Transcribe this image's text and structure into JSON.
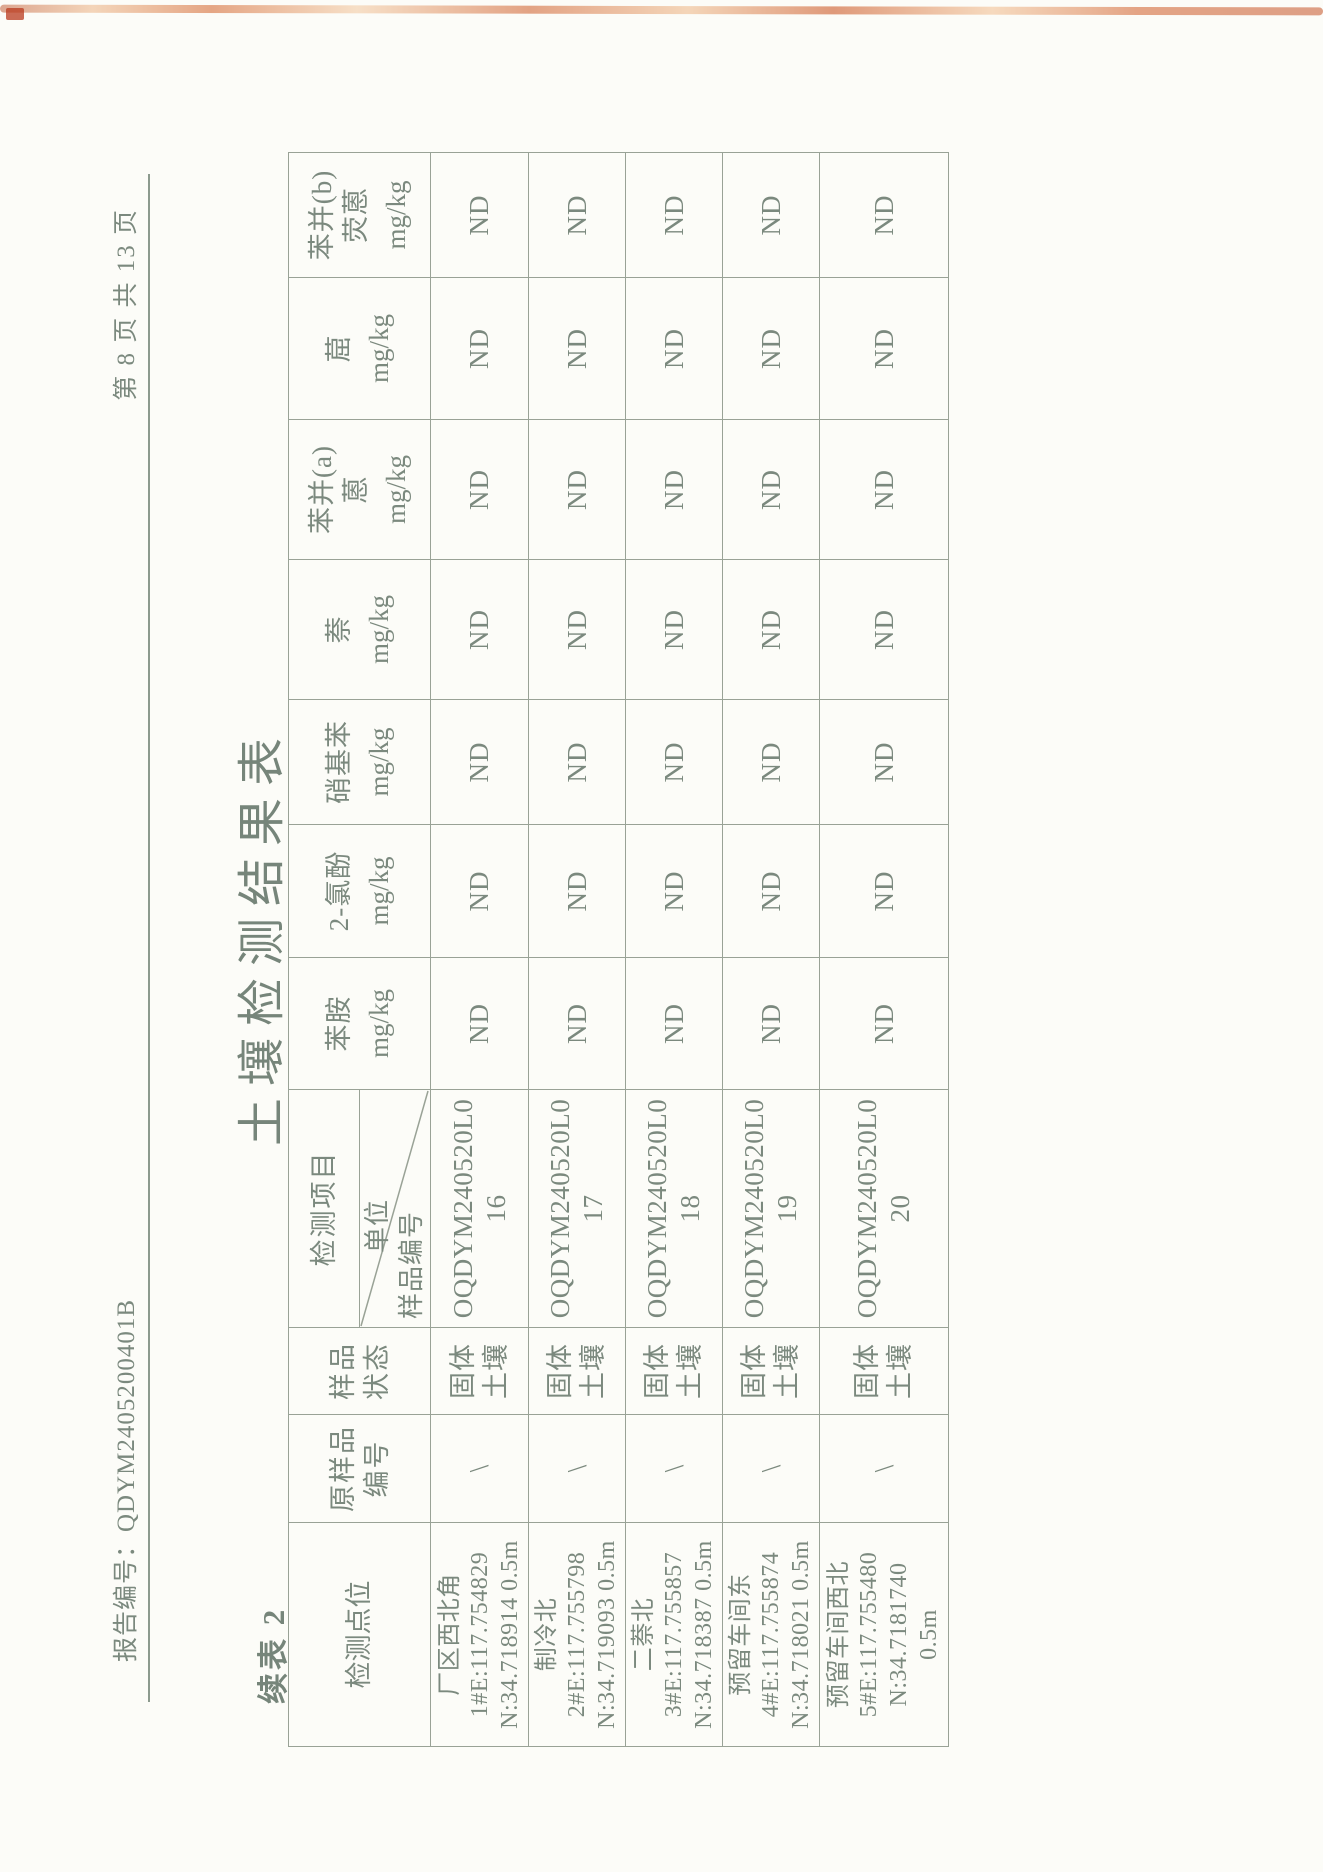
{
  "page": {
    "report_number": "报告编号：QDYM2405200401B",
    "page_indicator": "第 8 页 共 13 页",
    "title": "土壤检测结果表",
    "continuation_label": "续表 2"
  },
  "table": {
    "header": {
      "point": "检测点位",
      "orig_sample": [
        "原样品",
        "编号"
      ],
      "state": [
        "样品",
        "状态"
      ],
      "corner": {
        "project": "检测项目",
        "unit": "单位",
        "sample_no": "样品编号"
      },
      "analytes": [
        {
          "name": [
            "苯胺"
          ],
          "unit": "mg/kg"
        },
        {
          "name": [
            "2-氯酚"
          ],
          "unit": "mg/kg"
        },
        {
          "name": [
            "硝基苯"
          ],
          "unit": "mg/kg"
        },
        {
          "name": [
            "萘"
          ],
          "unit": "mg/kg"
        },
        {
          "name": [
            "苯并(a)",
            "蒽"
          ],
          "unit": "mg/kg"
        },
        {
          "name": [
            "䓛"
          ],
          "unit": "mg/kg"
        },
        {
          "name": [
            "苯并(b)",
            "荧蒽"
          ],
          "unit": "mg/kg"
        }
      ]
    },
    "rows": [
      {
        "point": [
          "厂区西北角",
          "1#E:117.754829",
          "N:34.718914 0.5m"
        ],
        "orig": "\\",
        "state": [
          "固体",
          "土壤"
        ],
        "sample_id": [
          "OQDYM240520L0",
          "16"
        ],
        "values": [
          "ND",
          "ND",
          "ND",
          "ND",
          "ND",
          "ND",
          "ND"
        ]
      },
      {
        "point": [
          "制冷北",
          "2#E:117.755798",
          "N:34.719093 0.5m"
        ],
        "orig": "\\",
        "state": [
          "固体",
          "土壤"
        ],
        "sample_id": [
          "OQDYM240520L0",
          "17"
        ],
        "values": [
          "ND",
          "ND",
          "ND",
          "ND",
          "ND",
          "ND",
          "ND"
        ]
      },
      {
        "point": [
          "二萘北",
          "3#E:117.755857",
          "N:34.718387 0.5m"
        ],
        "orig": "\\",
        "state": [
          "固体",
          "土壤"
        ],
        "sample_id": [
          "OQDYM240520L0",
          "18"
        ],
        "values": [
          "ND",
          "ND",
          "ND",
          "ND",
          "ND",
          "ND",
          "ND"
        ]
      },
      {
        "point": [
          "预留车间东",
          "4#E:117.755874",
          "N:34.718021 0.5m"
        ],
        "orig": "\\",
        "state": [
          "固体",
          "土壤"
        ],
        "sample_id": [
          "OQDYM240520L0",
          "19"
        ],
        "values": [
          "ND",
          "ND",
          "ND",
          "ND",
          "ND",
          "ND",
          "ND"
        ]
      },
      {
        "point": [
          "预留车间西北",
          "5#E:117.755480",
          "N:34.7181740",
          "0.5m"
        ],
        "orig": "\\",
        "state": [
          "固体",
          "土壤"
        ],
        "sample_id": [
          "OQDYM240520L0",
          "20"
        ],
        "values": [
          "ND",
          "ND",
          "ND",
          "ND",
          "ND",
          "ND",
          "ND"
        ]
      }
    ]
  }
}
